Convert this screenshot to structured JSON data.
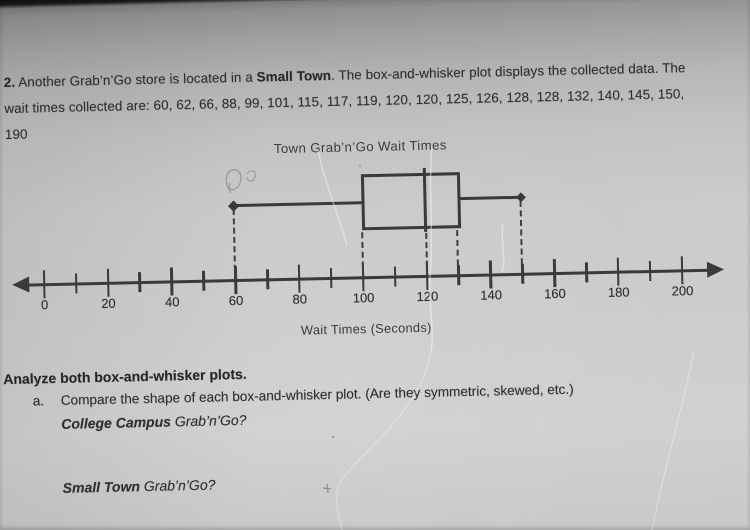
{
  "problem": {
    "number": "2.",
    "line1_pre": " Another Grab’n’Go store is located in a ",
    "line1_bold": "Small Town",
    "line1_post": ". The box-and-whisker plot displays the collected data.  The",
    "line2": "wait times collected are: 60, 62, 66, 88, 99, 101, 115, 117, 119, 120, 120, 125, 126, 128, 128, 132, 140, 145, 150,",
    "line3": "190"
  },
  "chart_data": {
    "type": "boxplot",
    "title": "Town Grab’n’Go Wait Times",
    "xlabel": "Wait Times (Seconds)",
    "axis": {
      "min": 0,
      "max": 200,
      "major_step": 20,
      "minor_step": 10
    },
    "box": {
      "min": 60,
      "q1": 100,
      "median": 120,
      "q3": 130,
      "max": 150
    },
    "dataset": [
      60,
      62,
      66,
      88,
      99,
      101,
      115,
      117,
      119,
      120,
      120,
      125,
      126,
      128,
      128,
      132,
      140,
      145,
      150,
      190
    ],
    "legend": "none",
    "grid": "off"
  },
  "analyze": {
    "heading": "Analyze both box-and-whisker plots.",
    "item_letter": "a.",
    "item_text": "Compare the shape of each box-and-whisker plot. (Are they symmetric, skewed, etc.)",
    "q1_bold": "College Campus",
    "q1_rest": " Grab’n’Go?",
    "q2_bold": "Small Town",
    "q2_rest": " Grab’n’Go?"
  }
}
